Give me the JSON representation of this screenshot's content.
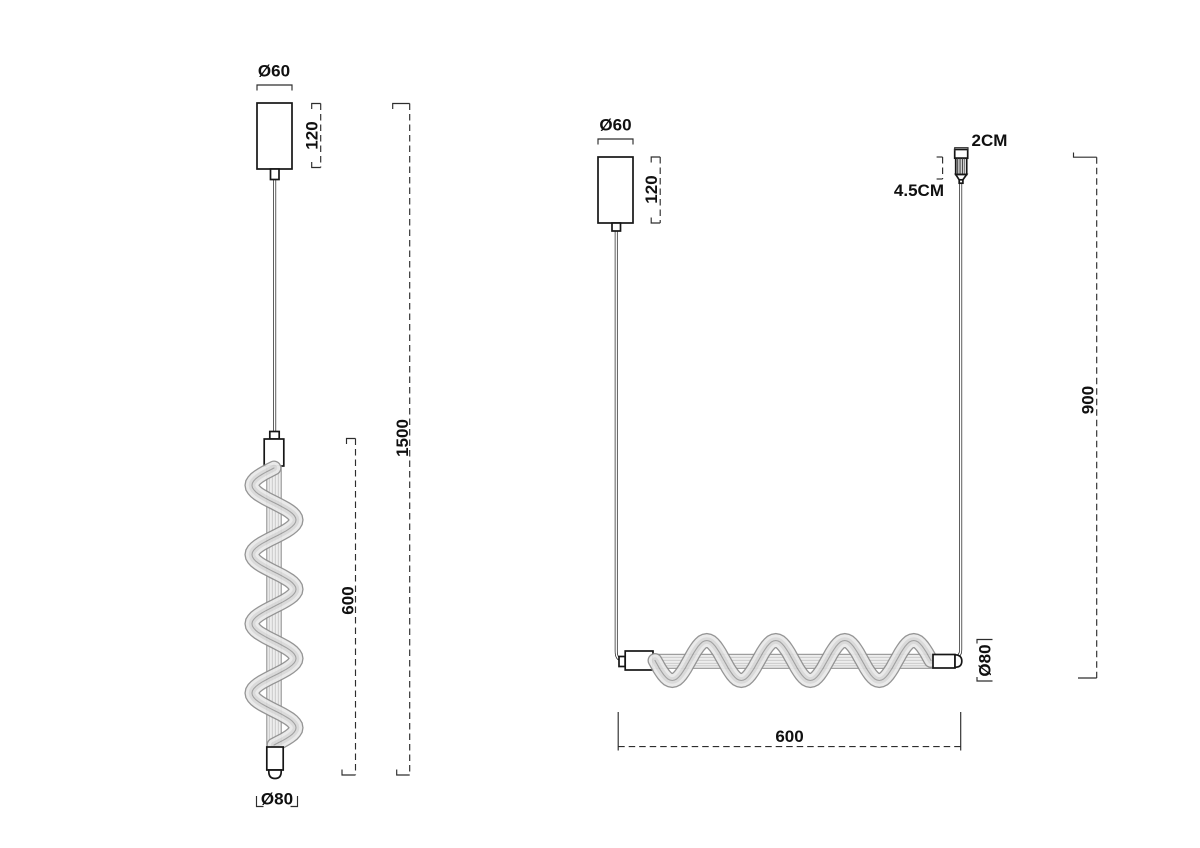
{
  "colors": {
    "line": "#161616",
    "dim_line": "#2d2d2d",
    "tube_fill": "#ededed",
    "spiral_fill": "#e9e9e9",
    "background": "#ffffff"
  },
  "left_drawing": {
    "canopy_diameter_label": "Ø60",
    "canopy_height_label": "120",
    "overall_height_label": "1500",
    "tube_length_label": "600",
    "bottom_diameter_label": "Ø80"
  },
  "right_drawing": {
    "canopy_diameter_label": "Ø60",
    "canopy_height_label": "120",
    "cord_grip_width_label": "2CM",
    "cord_grip_height_label": "4.5CM",
    "suspension_height_label": "900",
    "tube_diameter_label": "Ø80",
    "tube_length_label": "600"
  }
}
